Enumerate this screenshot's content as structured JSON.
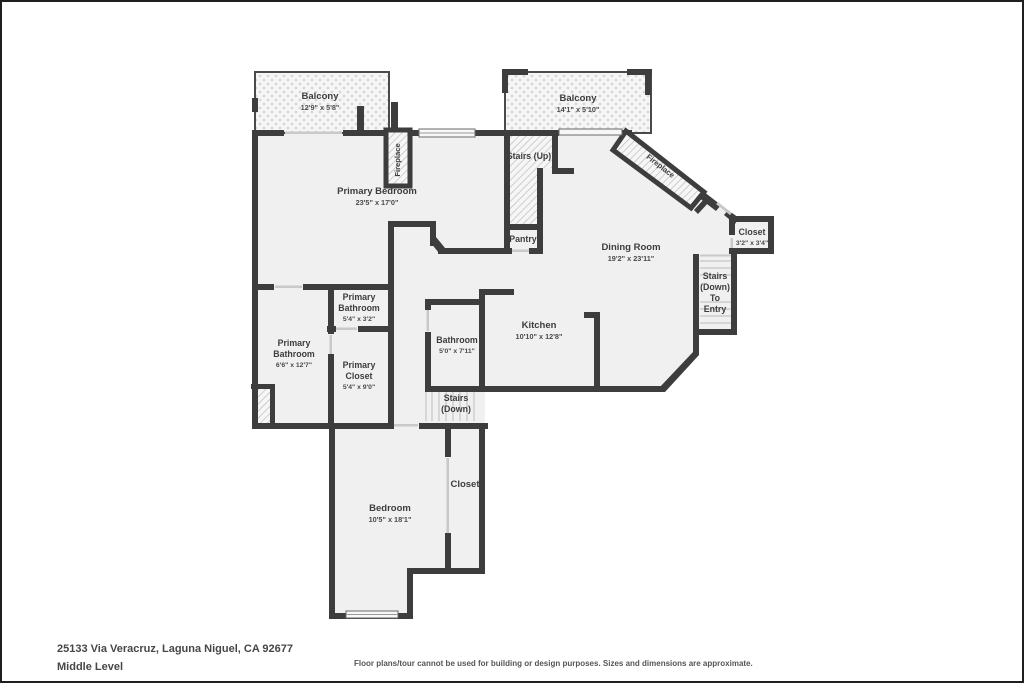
{
  "page": {
    "address": "25133 Via Veracruz, Laguna Niguel, CA 92677",
    "level": "Middle Level",
    "disclaimer": "Floor plans/tour cannot be used for building or design purposes. Sizes and dimensions are approximate."
  },
  "colors": {
    "wall": "#3d3d3d",
    "room_fill": "#f0f0f0",
    "door_line": "#c9c9c9",
    "hatch_line": "#bdbdbd",
    "balcony_dot": "#d6d6d6",
    "text": "#3d3d3d"
  },
  "rooms": {
    "balcony_left": {
      "name": "Balcony",
      "dims": "12'9\" x 5'8\""
    },
    "balcony_right": {
      "name": "Balcony",
      "dims": "14'1\" x 5'10\""
    },
    "primary_bedroom": {
      "name": "Primary Bedroom",
      "dims": "23'5\" x 17'0\""
    },
    "fireplace_bedroom": {
      "name": "Fireplace"
    },
    "fireplace_dining": {
      "name": "Fireplace"
    },
    "stairs_up": {
      "name": "Stairs (Up)"
    },
    "pantry": {
      "name": "Pantry"
    },
    "dining_room": {
      "name": "Dining Room",
      "dims": "19'2\" x 23'11\""
    },
    "closet_entry": {
      "name": "Closet",
      "dims": "3'2\" x 3'4\""
    },
    "stairs_entry": {
      "line1": "Stairs",
      "line2": "(Down)",
      "line3": "To",
      "line4": "Entry"
    },
    "kitchen": {
      "name": "Kitchen",
      "dims": "10'10\" x 12'8\""
    },
    "primary_bathroom_small": {
      "line1": "Primary",
      "line2": "Bathroom",
      "dims": "5'4\" x 3'2\""
    },
    "primary_bathroom": {
      "line1": "Primary",
      "line2": "Bathroom",
      "dims": "6'6\" x 12'7\""
    },
    "primary_closet": {
      "line1": "Primary",
      "line2": "Closet",
      "dims": "5'4\" x 9'0\""
    },
    "bathroom": {
      "name": "Bathroom",
      "dims": "5'0\" x 7'11\""
    },
    "stairs_down": {
      "line1": "Stairs",
      "line2": "(Down)"
    },
    "bedroom": {
      "name": "Bedroom",
      "dims": "10'5\" x 18'1\""
    },
    "closet_bedroom": {
      "name": "Closet"
    }
  }
}
